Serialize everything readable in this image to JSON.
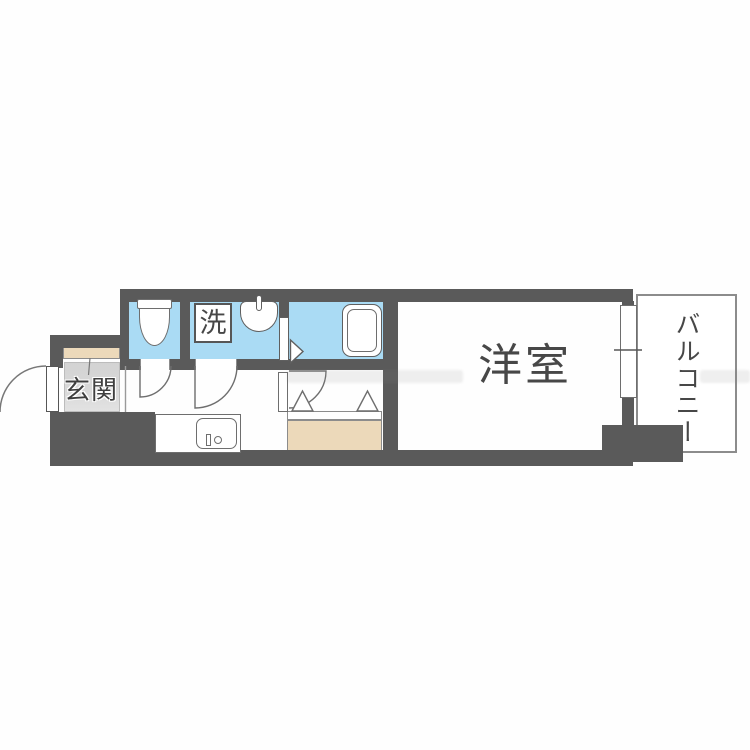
{
  "floor_plan": {
    "rooms": {
      "entrance": {
        "label": "玄関"
      },
      "laundry_marker": {
        "label": "洗"
      },
      "western_room": {
        "label": "洋室"
      },
      "balcony": {
        "label": "バルコニー"
      }
    },
    "fixtures": {
      "toilet": "toilet-top-view-icon",
      "wash_basin": "wash-basin-icon",
      "bathtub": "bathtub-icon",
      "kitchen_sink": "kitchen-sink-icon",
      "washer_pan": "washing-machine-space-marker",
      "closet": "closet-bifold-doors",
      "entrance_door": "outward-swing-door",
      "interior_doors": "swing-door-arcs",
      "window": "sliding-window-with-center-tick"
    },
    "colors": {
      "wall": "#5a5a5a",
      "water_room": "#aadbf4",
      "closet_tan": "#ecd9ba",
      "entrance_floor": "#d7d7d7",
      "outline": "#6e6e6e",
      "outline_light": "#8c8c8c",
      "label_text": "#474747",
      "watermark": "rgba(128,128,128,0.13)"
    }
  }
}
